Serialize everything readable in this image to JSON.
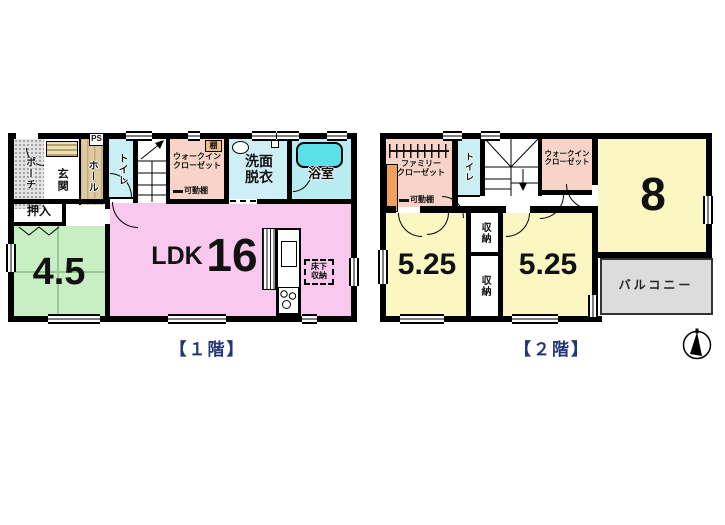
{
  "meta": {
    "title": "間取り図 (floor plan)",
    "floor_count": 2
  },
  "colors": {
    "wall": "#000000",
    "ldk_pink": "#f8c8ee",
    "tatami_green": "#c8eec4",
    "yellow_room": "#fbf7c3",
    "closet_salmon": "#f8d4c8",
    "cyan_room": "#c9eef4",
    "bath_cyan": "#b8ecf0",
    "tub_cyan": "#5ce0e8",
    "hall_tan": "#d8c69c",
    "balcony_gray": "#dcdcdc",
    "shelf_orange": "#f0a25c",
    "caption_navy": "#253575"
  },
  "floor1": {
    "caption": "【１階】",
    "porch": "ポーチ",
    "genkan": "玄関",
    "hall": "ホール",
    "ps": "PS",
    "toilet": "トイレ",
    "wic": "ウォークイン\nクローゼット",
    "shelf": "棚",
    "movable_shelf": "可動棚",
    "washroom": "洗面\n脱衣",
    "bath": "浴室",
    "oshiire": "押入",
    "tatami_size": "4.5",
    "ldk": "LDK",
    "ldk_size": "16",
    "underfloor_storage": "床下\n収納"
  },
  "floor2": {
    "caption": "【２階】",
    "family_closet": "ファミリー\nクローゼット",
    "movable_shelf": "可動棚",
    "toilet": "トイレ",
    "wic": "ウォークイン\nクローゼット",
    "room8_size": "8",
    "room525_left": "5.25",
    "room525_right": "5.25",
    "storage_top": "収納",
    "storage_bottom": "収納",
    "balcony": "バルコニー"
  }
}
